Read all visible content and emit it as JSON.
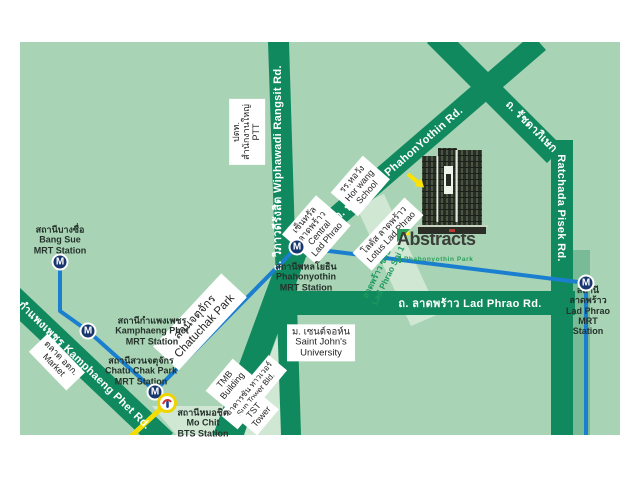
{
  "colors": {
    "map_bg": "#a8d3b4",
    "road_green": "#11895f",
    "block_pale": "#cfe7d3",
    "mrt_line_blue": "#1b7fd0",
    "bts_line_yellow": "#f3de00",
    "mrt_icon_navy": "#17356e",
    "soi_text_green": "#1e9b5e",
    "logo_green": "#2aa05c",
    "logo_text": "#3b3e38"
  },
  "roads": {
    "wiphawadi": "ถ. วิภาวดีรังสิต Wiphawadi Rangsit Rd.",
    "phahonyothin": "ถ. พหลโยธิน PhahonYothin Rd.",
    "ladphrao": "ถ. ลาดพร้าว Lad Phrao Rd.",
    "kamphaengphet": "ถ. กำแพงเพชร Kamphaeng Phet Rd.",
    "ratchada_thai": "ถ. รัชดาภิเษก",
    "ratchada_eng": "Ratchada Pisek Rd.",
    "soi_ladphrao1": "ลาดพร้าว ซอย 1\nLad Phrao Soi 1"
  },
  "stations": {
    "mrt_icon_letter": "M",
    "bang_sue": "สถานีบางซื่อ\nBang Sue\nMRT Station",
    "kamphaeng_phet": "สถานีกำแพงเพชร\nKamphaeng Phet\nMRT Station",
    "chatuchak": "สถานีสวนจตุจักร\nChatu Chak Park\nMRT Station",
    "phahonyothin": "สถานีพหลโยธิน\nPhahonyothin\nMRT Station",
    "lad_phrao": "สถานีลาดพร้าว\nLad Phrao\nMRT Station",
    "mo_chit": "สถานีหมอชิต\nMo Chit\nBTS Station"
  },
  "places": {
    "ptt": "ปตท.\nสำนักงานใหญ่\nPTT",
    "hor_wang": "รร.หอวัง\nHor wang\nSchool",
    "central_ladphrao": "เซ็นทรัล\nลาดพร้าว\nCentral\nLad Phrao",
    "lotus_ladphrao": "โลตัส ลาดพร้าว\nLotus Lad Phrao",
    "market": "ตลาด อตก.\nMarket",
    "chatuchak_park": "สวนจตุจักร\nChatuchak Park",
    "tmb": "TMB\nBuilding",
    "sun_tower": "อาคารซัน ทาวเวอร์\nSun Tower Bld.",
    "tst": "TST\nTower",
    "saint_johns": "ม. เซนต์จอห์น\nSaint John's\nUniversity"
  },
  "logo": {
    "title": "Abstracts",
    "subtitle": "Phahonyothin Park"
  }
}
